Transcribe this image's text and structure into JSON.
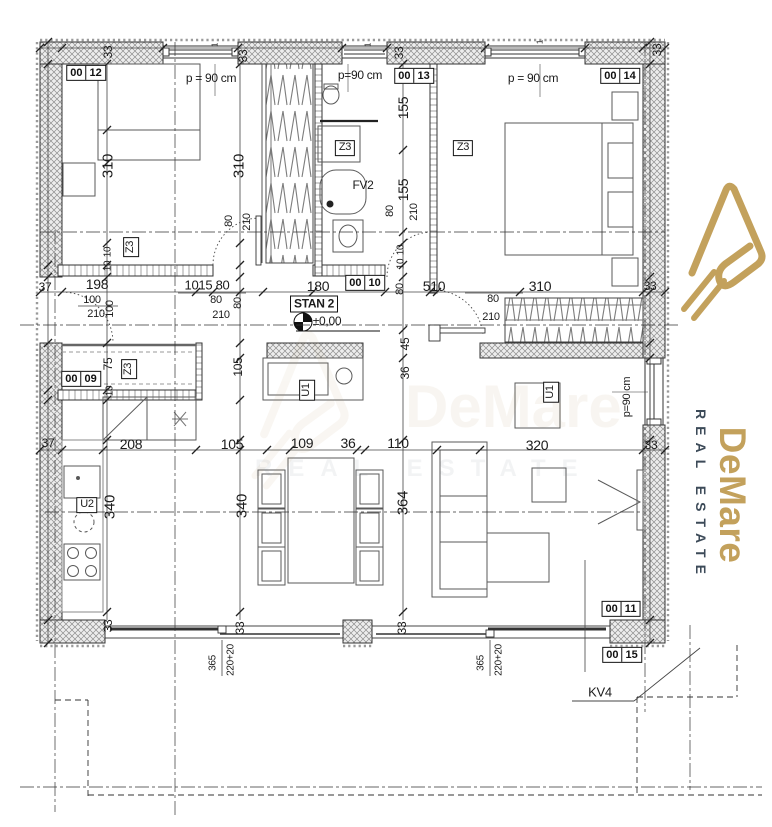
{
  "logo": {
    "name": "DeMare",
    "tagline": "REAL ESTATE",
    "colors": {
      "gold": "#C3A15C",
      "dark": "#3C4A58"
    }
  },
  "watermark": {
    "name": "DeMare",
    "tagline": "REAL ESTATE"
  },
  "unit": {
    "label": "STAN 2",
    "level": "±0,00"
  },
  "room_tags": [
    {
      "a": "00",
      "b": "12",
      "x": 86,
      "y": 73
    },
    {
      "a": "00",
      "b": "13",
      "x": 414,
      "y": 76
    },
    {
      "a": "00",
      "b": "14",
      "x": 620,
      "y": 76
    },
    {
      "a": "00",
      "b": "10",
      "x": 365,
      "y": 283
    },
    {
      "a": "00",
      "b": "09",
      "x": 81,
      "y": 379
    },
    {
      "a": "00",
      "b": "11",
      "x": 621,
      "y": 609
    },
    {
      "a": "00",
      "b": "15",
      "x": 622,
      "y": 655
    }
  ],
  "boxed_labels": [
    {
      "t": "STAN 2",
      "x": 314,
      "y": 304,
      "s": 12,
      "bold": true
    },
    {
      "t": "Z3",
      "x": 131,
      "y": 247,
      "r": -90,
      "s": 11
    },
    {
      "t": "Z3",
      "x": 345,
      "y": 148,
      "s": 11
    },
    {
      "t": "Z3",
      "x": 463,
      "y": 148,
      "s": 11
    },
    {
      "t": "Z3",
      "x": 129,
      "y": 369,
      "r": -90,
      "s": 11
    },
    {
      "t": "U1",
      "x": 307,
      "y": 390,
      "r": -90,
      "s": 11
    },
    {
      "t": "U1",
      "x": 551,
      "y": 392,
      "r": -90,
      "s": 11
    },
    {
      "t": "U2",
      "x": 87,
      "y": 505,
      "s": 11
    }
  ],
  "notes": [
    {
      "t": "p = 90 cm",
      "x": 211,
      "y": 78,
      "s": 12
    },
    {
      "t": "p=90 cm",
      "x": 360,
      "y": 75,
      "s": 12
    },
    {
      "t": "p = 90 cm",
      "x": 533,
      "y": 78,
      "s": 12
    },
    {
      "t": "p=90 cm",
      "x": 627,
      "y": 397,
      "r": -90,
      "s": 11
    },
    {
      "t": "±0,00",
      "x": 327,
      "y": 321,
      "s": 12
    },
    {
      "t": "FV2",
      "x": 363,
      "y": 185,
      "s": 12
    },
    {
      "t": "KV4",
      "x": 600,
      "y": 692,
      "s": 13
    },
    {
      "t": "1",
      "x": 215,
      "y": 45,
      "r": -90,
      "s": 8
    },
    {
      "t": "1",
      "x": 368,
      "y": 45,
      "r": -90,
      "s": 8
    },
    {
      "t": "1",
      "x": 540,
      "y": 42,
      "r": -90,
      "s": 8
    }
  ],
  "dims": [
    {
      "t": "33",
      "x": 108,
      "y": 52,
      "r": -90,
      "s": 12
    },
    {
      "t": "33",
      "x": 243,
      "y": 56,
      "r": -90,
      "s": 12
    },
    {
      "t": "33",
      "x": 399,
      "y": 53,
      "r": -90,
      "s": 12
    },
    {
      "t": "33",
      "x": 657,
      "y": 50,
      "r": -90,
      "s": 12
    },
    {
      "t": "310",
      "x": 108,
      "y": 166,
      "r": -90,
      "s": 15
    },
    {
      "t": "310",
      "x": 239,
      "y": 166,
      "r": -90,
      "s": 15
    },
    {
      "t": "155",
      "x": 403,
      "y": 108,
      "r": -90,
      "s": 14
    },
    {
      "t": "155",
      "x": 403,
      "y": 190,
      "r": -90,
      "s": 14
    },
    {
      "t": "80",
      "x": 390,
      "y": 211,
      "r": -90,
      "s": 11
    },
    {
      "t": "210",
      "x": 414,
      "y": 212,
      "r": -90,
      "s": 11
    },
    {
      "t": "80",
      "x": 229,
      "y": 221,
      "r": -90,
      "s": 11
    },
    {
      "t": "210",
      "x": 247,
      "y": 222,
      "r": -90,
      "s": 11
    },
    {
      "t": "10",
      "x": 108,
      "y": 252,
      "r": -90,
      "s": 10
    },
    {
      "t": "10",
      "x": 108,
      "y": 266,
      "r": -90,
      "s": 10
    },
    {
      "t": "10",
      "x": 401,
      "y": 250,
      "r": -90,
      "s": 10
    },
    {
      "t": "10",
      "x": 401,
      "y": 264,
      "r": -90,
      "s": 10
    },
    {
      "t": "37",
      "x": 45,
      "y": 287,
      "s": 12
    },
    {
      "t": "198",
      "x": 97,
      "y": 284,
      "s": 14
    },
    {
      "t": "100",
      "x": 92,
      "y": 300,
      "s": 11
    },
    {
      "t": "210",
      "x": 96,
      "y": 314,
      "s": 11
    },
    {
      "t": "100",
      "x": 110,
      "y": 309,
      "r": -90,
      "s": 11
    },
    {
      "t": "1015 80",
      "x": 207,
      "y": 285,
      "s": 13
    },
    {
      "t": "80",
      "x": 216,
      "y": 300,
      "s": 11
    },
    {
      "t": "210",
      "x": 221,
      "y": 315,
      "s": 11
    },
    {
      "t": "80",
      "x": 238,
      "y": 303,
      "r": -90,
      "s": 11
    },
    {
      "t": "180",
      "x": 318,
      "y": 286,
      "s": 14
    },
    {
      "t": "80",
      "x": 400,
      "y": 289,
      "r": -90,
      "s": 11
    },
    {
      "t": "510",
      "x": 434,
      "y": 286,
      "s": 14
    },
    {
      "t": "80",
      "x": 493,
      "y": 299,
      "s": 11
    },
    {
      "t": "210",
      "x": 491,
      "y": 317,
      "s": 11
    },
    {
      "t": "310",
      "x": 540,
      "y": 286,
      "s": 14
    },
    {
      "t": "33",
      "x": 650,
      "y": 286,
      "s": 12
    },
    {
      "t": "75",
      "x": 108,
      "y": 364,
      "r": -90,
      "s": 12
    },
    {
      "t": "10",
      "x": 110,
      "y": 391,
      "r": -90,
      "s": 10
    },
    {
      "t": "105",
      "x": 238,
      "y": 367,
      "r": -90,
      "s": 12
    },
    {
      "t": "45",
      "x": 405,
      "y": 344,
      "r": -90,
      "s": 12
    },
    {
      "t": "36",
      "x": 405,
      "y": 373,
      "r": -90,
      "s": 12
    },
    {
      "t": "37",
      "x": 48,
      "y": 443,
      "s": 12
    },
    {
      "t": "208",
      "x": 131,
      "y": 444,
      "s": 14
    },
    {
      "t": "105",
      "x": 232,
      "y": 444,
      "s": 14
    },
    {
      "t": "109",
      "x": 302,
      "y": 443,
      "s": 14
    },
    {
      "t": "36",
      "x": 348,
      "y": 443,
      "s": 14
    },
    {
      "t": "110",
      "x": 398,
      "y": 443,
      "s": 14
    },
    {
      "t": "320",
      "x": 537,
      "y": 445,
      "s": 14
    },
    {
      "t": "33",
      "x": 651,
      "y": 445,
      "s": 12
    },
    {
      "t": "340",
      "x": 110,
      "y": 507,
      "r": -90,
      "s": 15
    },
    {
      "t": "340",
      "x": 242,
      "y": 506,
      "r": -90,
      "s": 15
    },
    {
      "t": "364",
      "x": 403,
      "y": 503,
      "r": -90,
      "s": 15
    },
    {
      "t": "33",
      "x": 108,
      "y": 626,
      "r": -90,
      "s": 12
    },
    {
      "t": "33",
      "x": 240,
      "y": 628,
      "r": -90,
      "s": 12
    },
    {
      "t": "33",
      "x": 402,
      "y": 628,
      "r": -90,
      "s": 12
    },
    {
      "t": "365",
      "x": 213,
      "y": 663,
      "r": -90,
      "s": 10
    },
    {
      "t": "220+20",
      "x": 231,
      "y": 660,
      "r": -90,
      "s": 10
    },
    {
      "t": "365",
      "x": 481,
      "y": 663,
      "r": -90,
      "s": 10
    },
    {
      "t": "220+20",
      "x": 499,
      "y": 660,
      "r": -90,
      "s": 10
    }
  ]
}
